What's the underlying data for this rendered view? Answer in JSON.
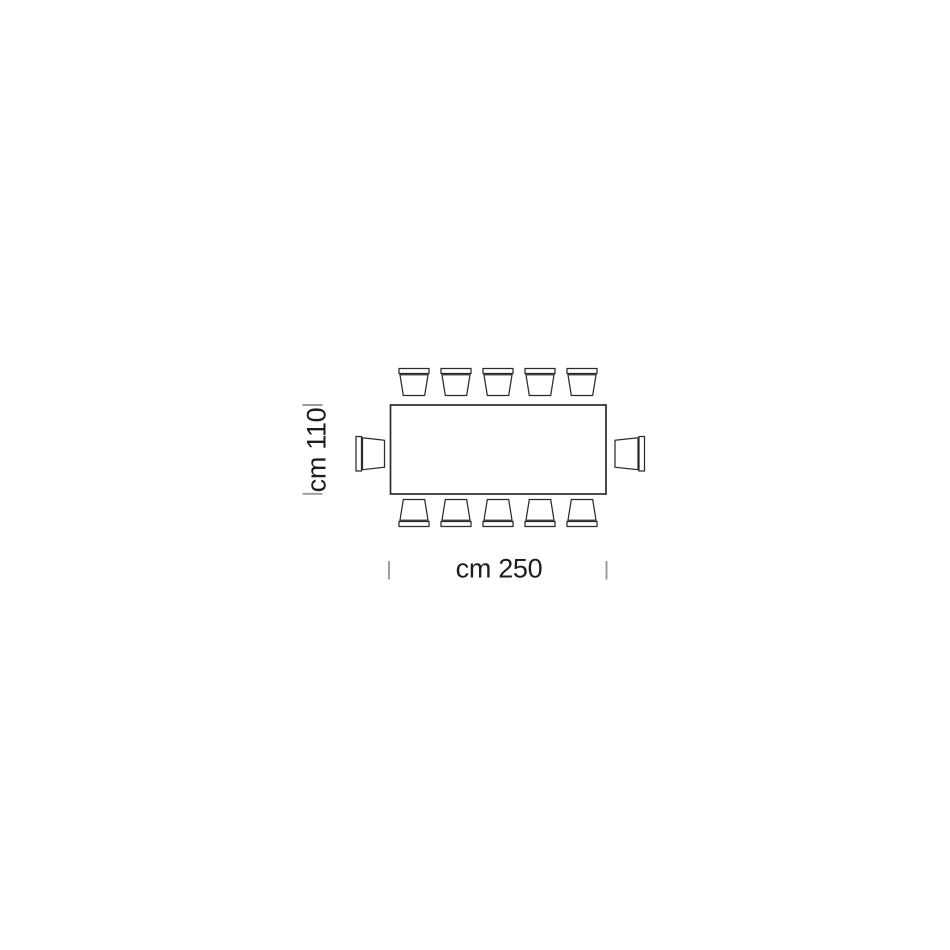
{
  "diagram": {
    "name": "dining-table-seating-plan-top-view",
    "table": {
      "shape": "rectangle",
      "length_cm": 250,
      "width_cm": 110
    },
    "dimensions": {
      "width_label": "cm 250",
      "depth_label": "cm 110"
    },
    "seats": {
      "top_row": 5,
      "bottom_row": 5,
      "left_end": 1,
      "right_end": 1,
      "total": 12
    },
    "colors": {
      "outline": "#2b2b2b",
      "tick": "#9a9a9a",
      "text": "#1d1d1d",
      "background": "#ffffff"
    }
  }
}
